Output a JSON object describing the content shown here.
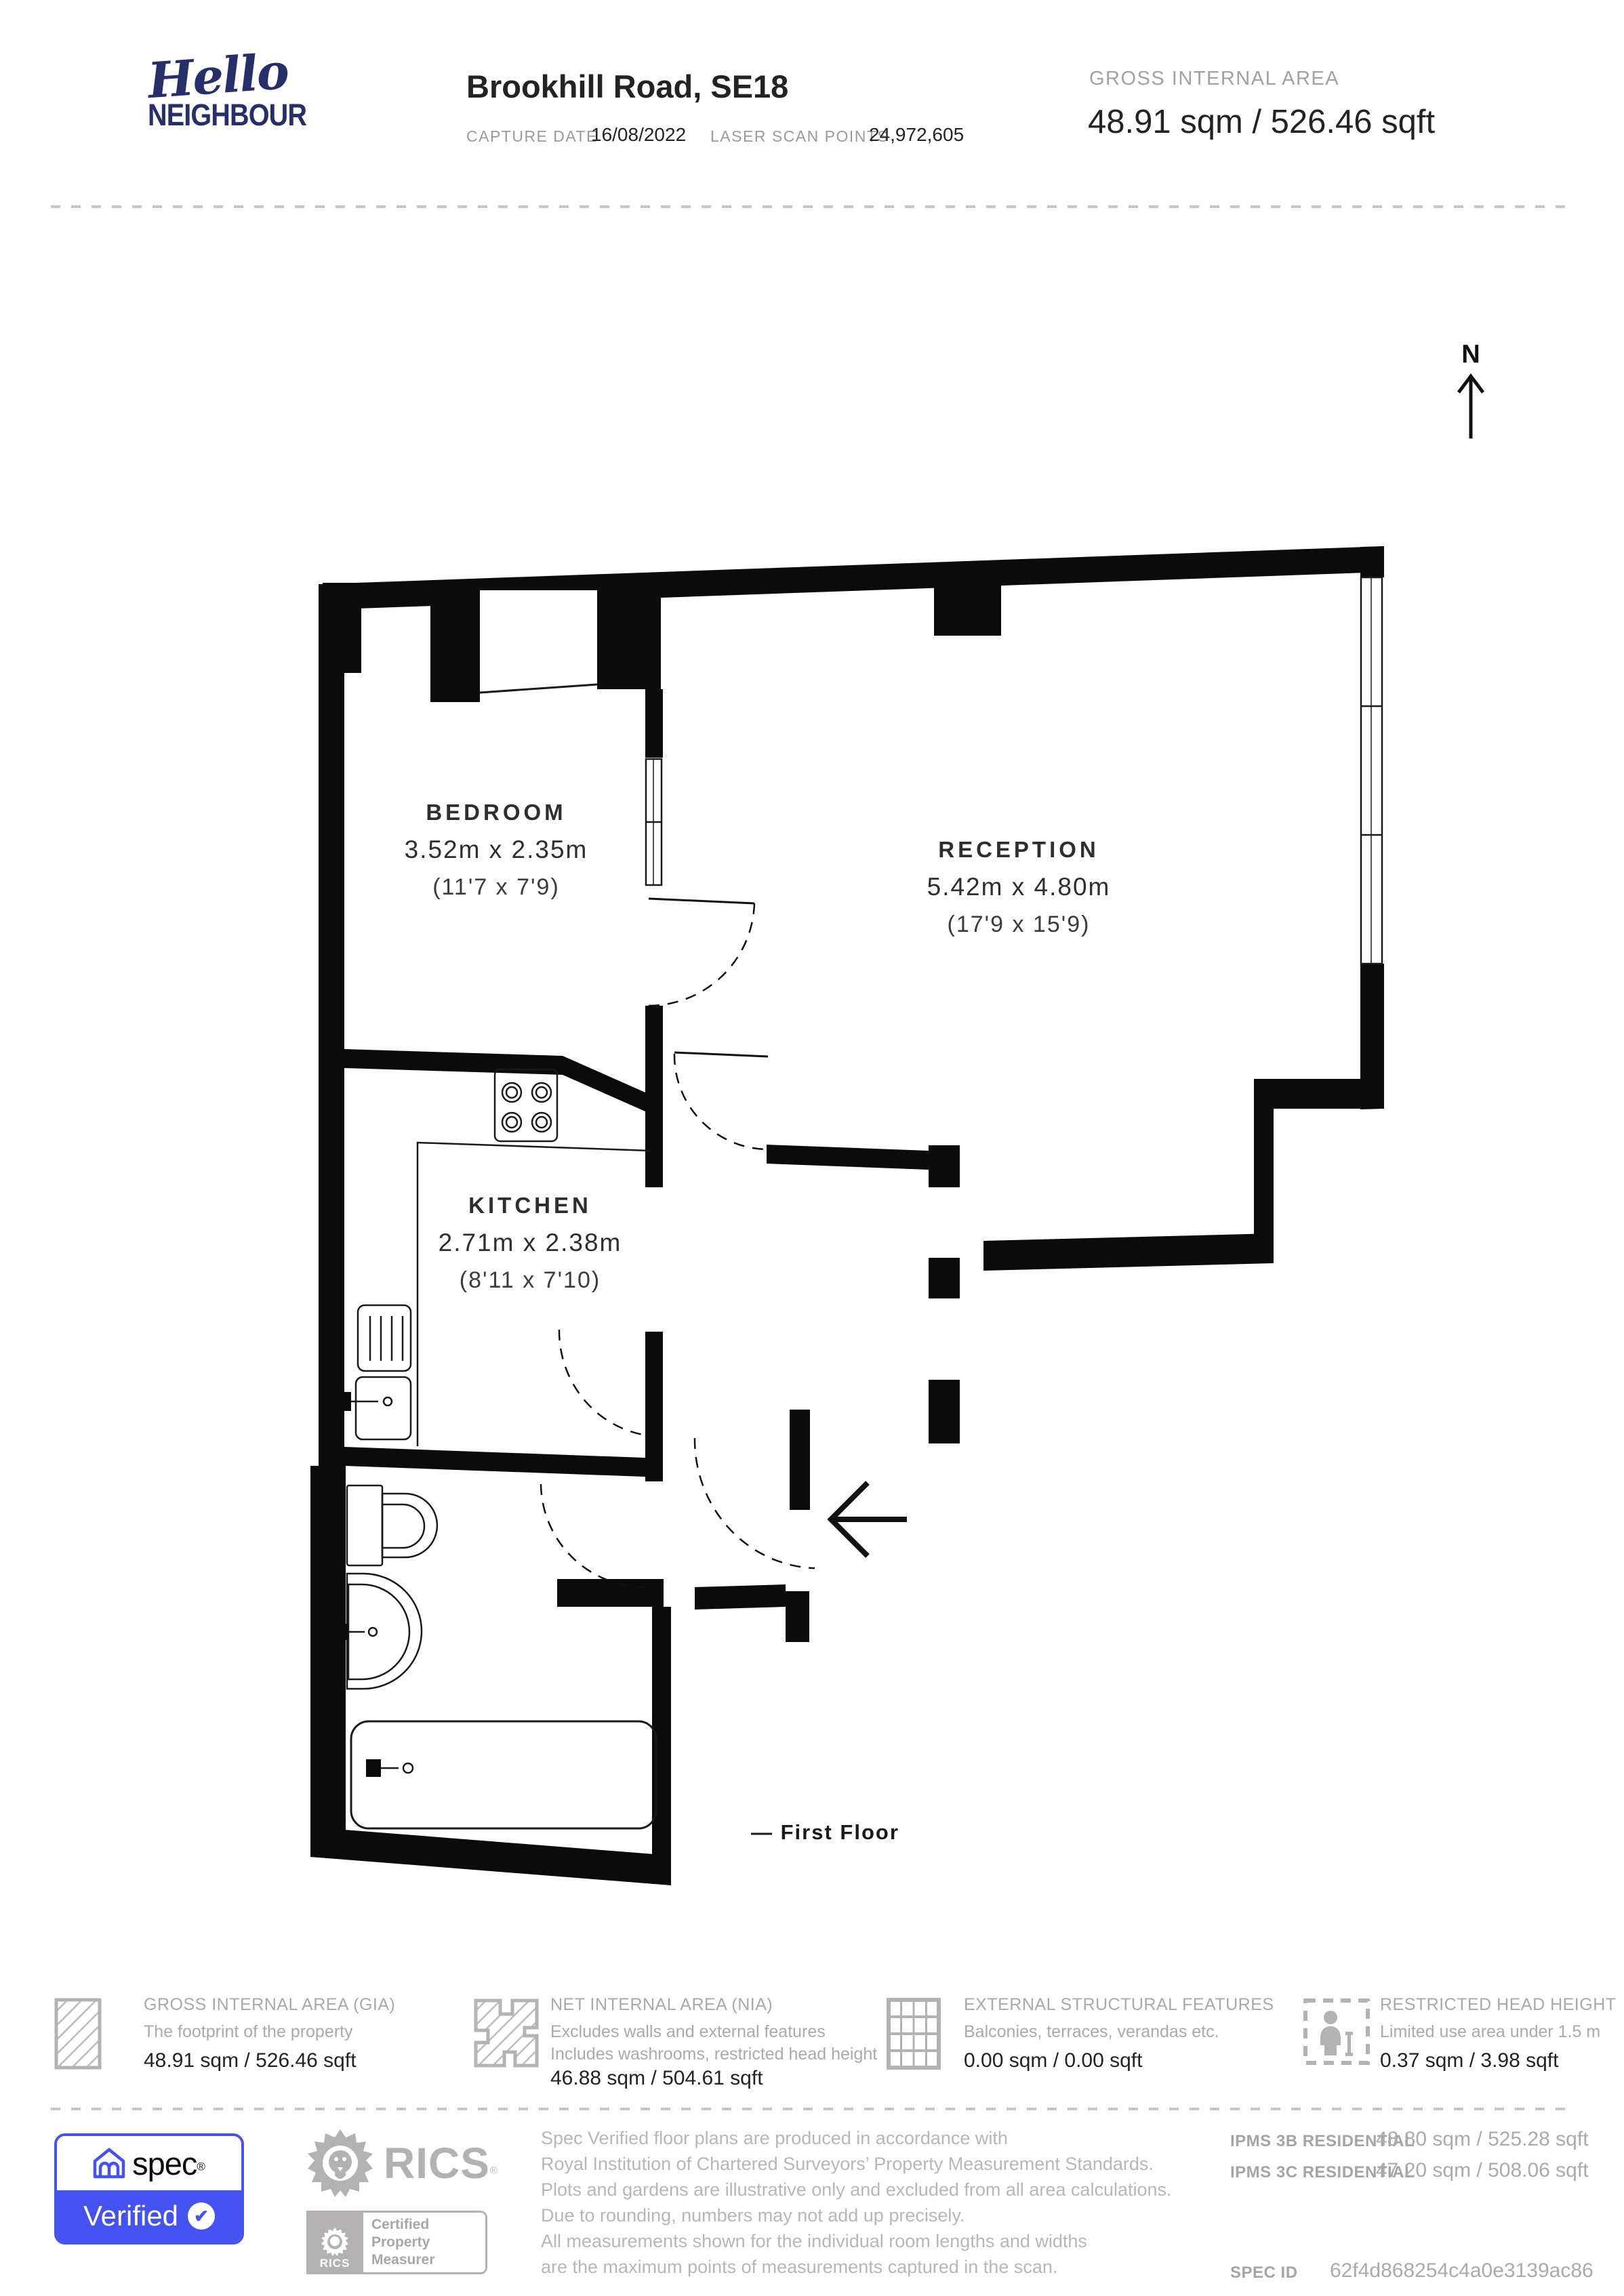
{
  "colors": {
    "accent_blue": "#4352f0",
    "logo_navy": "#262f6a",
    "wall_black": "#0b0b0b",
    "gray_text": "#a9a9a9",
    "rics_gray": "#b3b1b2"
  },
  "header": {
    "logo_line1": "Hello",
    "logo_line2": "NEIGHBOUR",
    "title": "Brookhill Road, SE18",
    "capture_date_label": "CAPTURE DATE",
    "capture_date_value": "16/08/2022",
    "laser_scan_label": "LASER SCAN POINTS",
    "laser_scan_value": "24,972,605",
    "gia_label": "GROSS INTERNAL AREA",
    "gia_value": "48.91 sqm / 526.46 sqft"
  },
  "plan": {
    "north_label": "N",
    "caption": "—  First Floor",
    "rooms": {
      "bedroom": {
        "name": "BEDROOM",
        "metric": "3.52m x 2.35m",
        "imperial": "(11'7 x 7'9)"
      },
      "reception": {
        "name": "RECEPTION",
        "metric": "5.42m x 4.80m",
        "imperial": "(17'9 x 15'9)"
      },
      "kitchen": {
        "name": "KITCHEN",
        "metric": "2.71m x 2.38m",
        "imperial": "(8'11 x 7'10)"
      }
    }
  },
  "legend": {
    "items": [
      {
        "title": "GROSS INTERNAL AREA (GIA)",
        "desc1": "The footprint of the property",
        "desc2": "",
        "value": "48.91 sqm / 526.46 sqft"
      },
      {
        "title": "NET INTERNAL AREA (NIA)",
        "desc1": "Excludes walls and external features",
        "desc2": "Includes washrooms, restricted head height",
        "value": "46.88 sqm / 504.61 sqft"
      },
      {
        "title": "EXTERNAL STRUCTURAL FEATURES",
        "desc1": "Balconies, terraces, verandas etc.",
        "desc2": "",
        "value": "0.00 sqm / 0.00 sqft"
      },
      {
        "title": "RESTRICTED HEAD HEIGHT",
        "desc1": "Limited use area under 1.5 m",
        "desc2": "",
        "value": "0.37 sqm / 3.98 sqft"
      }
    ]
  },
  "footer": {
    "spec": {
      "brand": "spec",
      "reg": "®",
      "verified": "Verified",
      "check": "✔"
    },
    "rics": {
      "brand": "RICS",
      "reg": "®",
      "cert1": "Certified",
      "cert2": "Property",
      "cert3": "Measurer"
    },
    "disclaimer": [
      "Spec Verified floor plans are produced in accordance with",
      "Royal Institution of Chartered Surveyors’ Property Measurement Standards.",
      "Plots and gardens are illustrative only and excluded from all area calculations.",
      "Due to rounding, numbers may not add up precisely.",
      "All measurements shown for the individual room lengths and widths",
      "are the maximum points of measurements captured in the scan."
    ],
    "ipms": {
      "b_label": "IPMS 3B RESIDENTIAL",
      "b_value": "48.80 sqm / 525.28 sqft",
      "c_label": "IPMS 3C RESIDENTIAL",
      "c_value": "47.20 sqm / 508.06 sqft",
      "spec_id_label": "SPEC ID",
      "spec_id_value": "62f4d868254c4a0e3139ac86"
    }
  }
}
